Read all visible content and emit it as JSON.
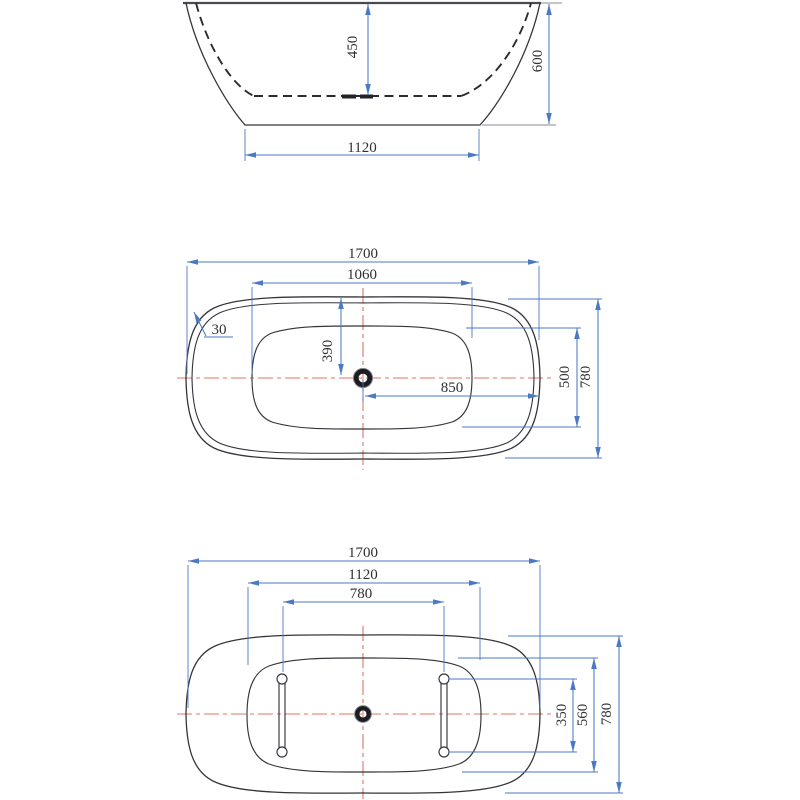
{
  "meta": {
    "title": "Freestanding bathtub dimensional drawing",
    "units": "mm"
  },
  "colors": {
    "outline": "#34353b",
    "dimension_blue": "#4b79c4",
    "centerline_red": "#dd7468",
    "drain_ring": "#1c1d22",
    "background": "#ffffff"
  },
  "front_view": {
    "name": "front-elevation",
    "dims": {
      "inner_depth": "450",
      "overall_height": "600",
      "base_width": "1120"
    }
  },
  "top_view": {
    "name": "top-plan",
    "dims": {
      "overall_length": "1700",
      "opening_length": "1060",
      "rim_thickness": "30",
      "center_to_side": "390",
      "center_to_end": "850",
      "opening_width": "500",
      "overall_width": "780"
    }
  },
  "bottom_view": {
    "name": "bottom-plan",
    "dims": {
      "overall_length": "1700",
      "base_length": "1120",
      "slot_spacing": "780",
      "slot_length": "350",
      "base_width": "560",
      "overall_width": "780"
    }
  }
}
